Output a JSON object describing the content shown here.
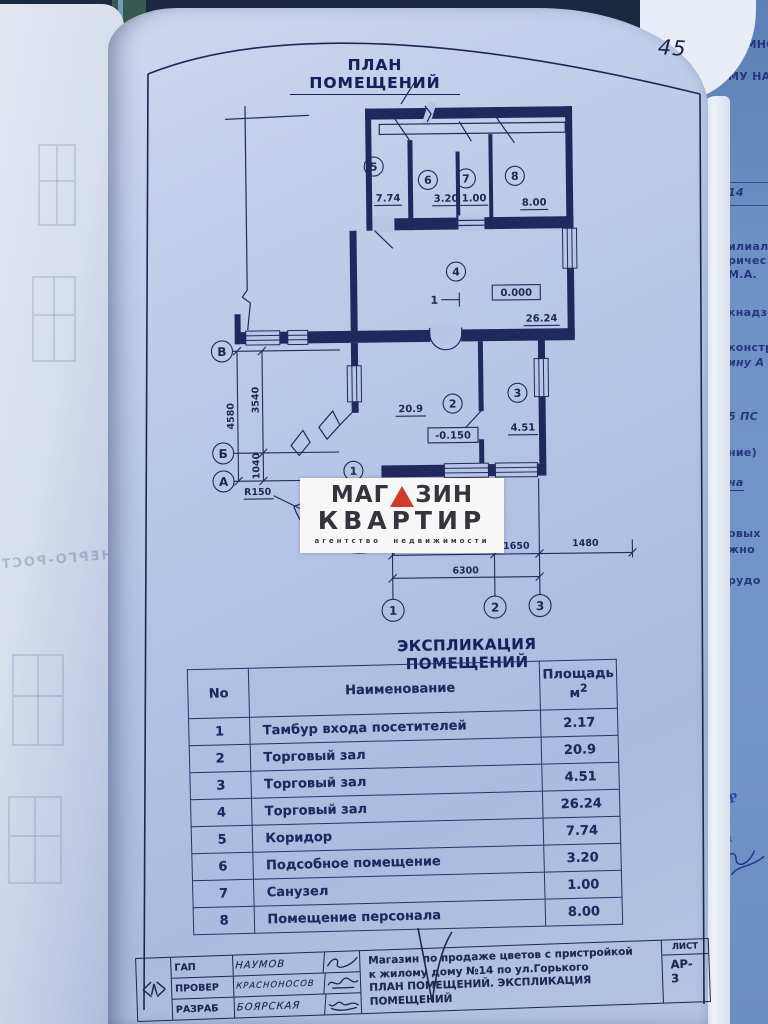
{
  "page": {
    "number": "45",
    "plan_title": "ПЛАН ПОМЕЩЕНИЙ",
    "explication_title": "ЭКСПЛИКАЦИЯ ПОМЕЩЕНИЙ"
  },
  "plan": {
    "rooms": [
      {
        "num": "1",
        "area": ""
      },
      {
        "num": "2",
        "area": "20.9"
      },
      {
        "num": "3",
        "area": "4.51"
      },
      {
        "num": "4",
        "area": "26.24"
      },
      {
        "num": "5",
        "area": "7.74"
      },
      {
        "num": "6",
        "area": "3.20"
      },
      {
        "num": "7",
        "area": "1.00"
      },
      {
        "num": "8",
        "area": "8.00"
      }
    ],
    "elevations": {
      "room4": "0.000",
      "room2": "-0.150"
    },
    "direction_marker": "1",
    "radius_label": "R150",
    "axes": {
      "row_letters": [
        "В",
        "Б",
        "А"
      ],
      "col_numbers": [
        "1",
        "2",
        "3"
      ]
    },
    "dimensions": {
      "vertical_total": "4580",
      "vertical_parts": [
        "3540",
        "1040"
      ],
      "bottom_parts": [
        "4650",
        "1650",
        "1480"
      ],
      "bottom_total": "6300"
    }
  },
  "watermark": {
    "word1_prefix": "МАГ",
    "word1_suffix": "ЗИН",
    "word2": "КВАРТИР",
    "tagline": "агентство недвижимости",
    "triangle_color": "#d23b27"
  },
  "explication": {
    "headers": {
      "no": "No",
      "name": "Наименование",
      "area_line1": "Площадь",
      "area_unit": "м",
      "area_sup": "2"
    },
    "rows": [
      {
        "no": "1",
        "name": "Тамбур входа посетителей",
        "area": "2.17"
      },
      {
        "no": "2",
        "name": "Торговый зал",
        "area": "20.9"
      },
      {
        "no": "3",
        "name": "Торговый зал",
        "area": "4.51"
      },
      {
        "no": "4",
        "name": "Торговый зал",
        "area": "26.24"
      },
      {
        "no": "5",
        "name": "Коридор",
        "area": "7.74"
      },
      {
        "no": "6",
        "name": "Подсобное помещение",
        "area": "3.20"
      },
      {
        "no": "7",
        "name": "Санузел",
        "area": "1.00"
      },
      {
        "no": "8",
        "name": "Помещение персонала",
        "area": "8.00"
      }
    ]
  },
  "title_block": {
    "signers": [
      {
        "role": "ГАП",
        "name": "НАУМОВ"
      },
      {
        "role": "ПРОВЕР",
        "name": "КРАСНОНОСОВ"
      },
      {
        "role": "РАЗРАБ",
        "name": "БОЯРСКАЯ"
      }
    ],
    "doc_line1": "Магазин по продаже цветов с пристройкой",
    "doc_line2": "к жилому дому №14 по ул.Горького",
    "doc_line3": "ПЛАН ПОМЕЩЕНИЙ. ЭКСПЛИКАЦИЯ ПОМЕЩЕНИЙ",
    "sheet_label": "ЛИСТ",
    "sheet_value_line1": "АР-",
    "sheet_value_line2": "3"
  },
  "adjacent_page": {
    "fragments": [
      "ТОМНОМ",
      "МУ НАД",
      "14",
      "илиал",
      "ричес",
      "М.А.",
      "кнадзо",
      "констр",
      "ину А",
      "5 ПС",
      "ние)",
      "на",
      "овых",
      "жно",
      "рудо"
    ],
    "stamp": [
      "ГИ",
      "Р",
      "мол",
      "тех"
    ]
  },
  "left_page": {
    "ghost_text": "ЭНЕРГО-РОСТ"
  }
}
